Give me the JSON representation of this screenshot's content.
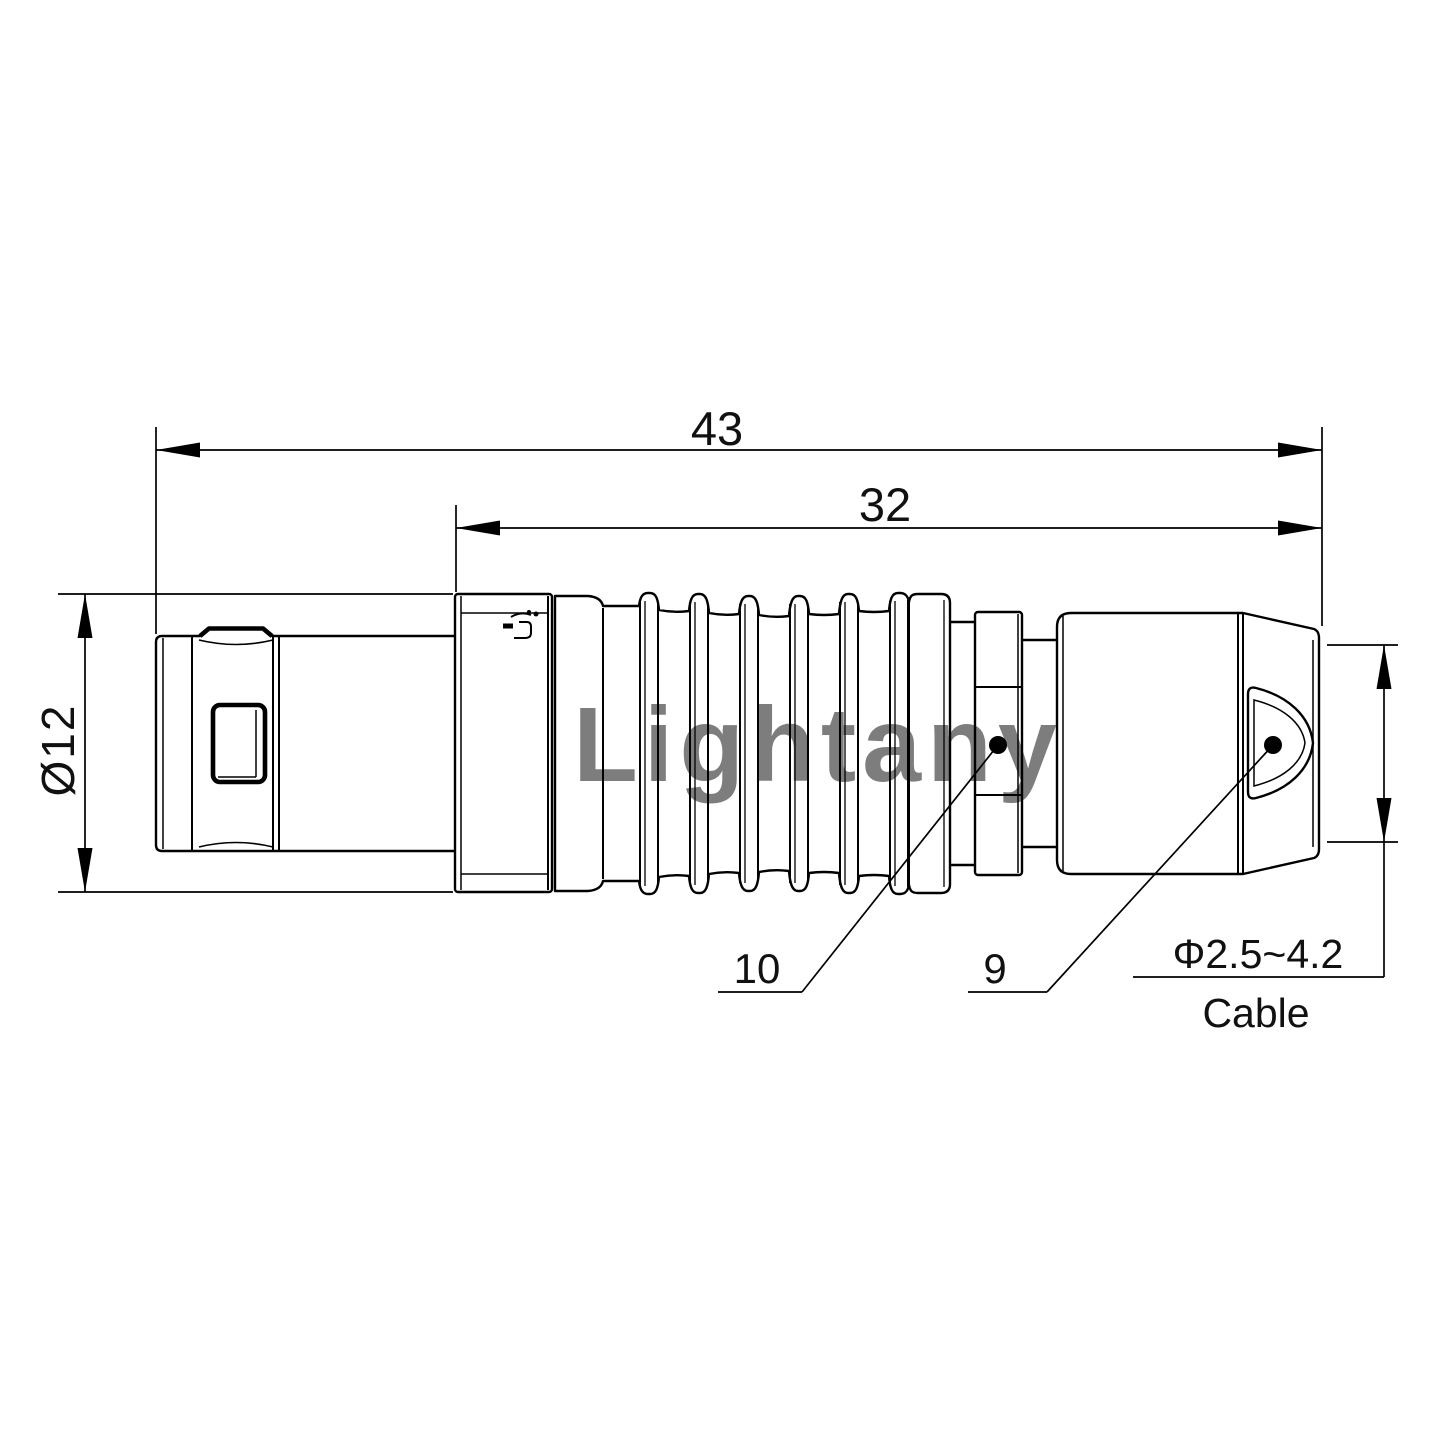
{
  "drawing": {
    "kind": "connector-dimension-drawing",
    "dimension_labels": {
      "overall_length": "43",
      "rear_length": "32",
      "body_diameter": "Ø12",
      "cable_diameter_range": "Φ2.5~4.2",
      "cable_caption": "Cable"
    },
    "part_callouts": {
      "collet_nut": "10",
      "rear_nut": "9"
    },
    "watermark": "Lightany",
    "colors": {
      "line": "#000000",
      "watermark_pink": "#edbfbf"
    }
  }
}
